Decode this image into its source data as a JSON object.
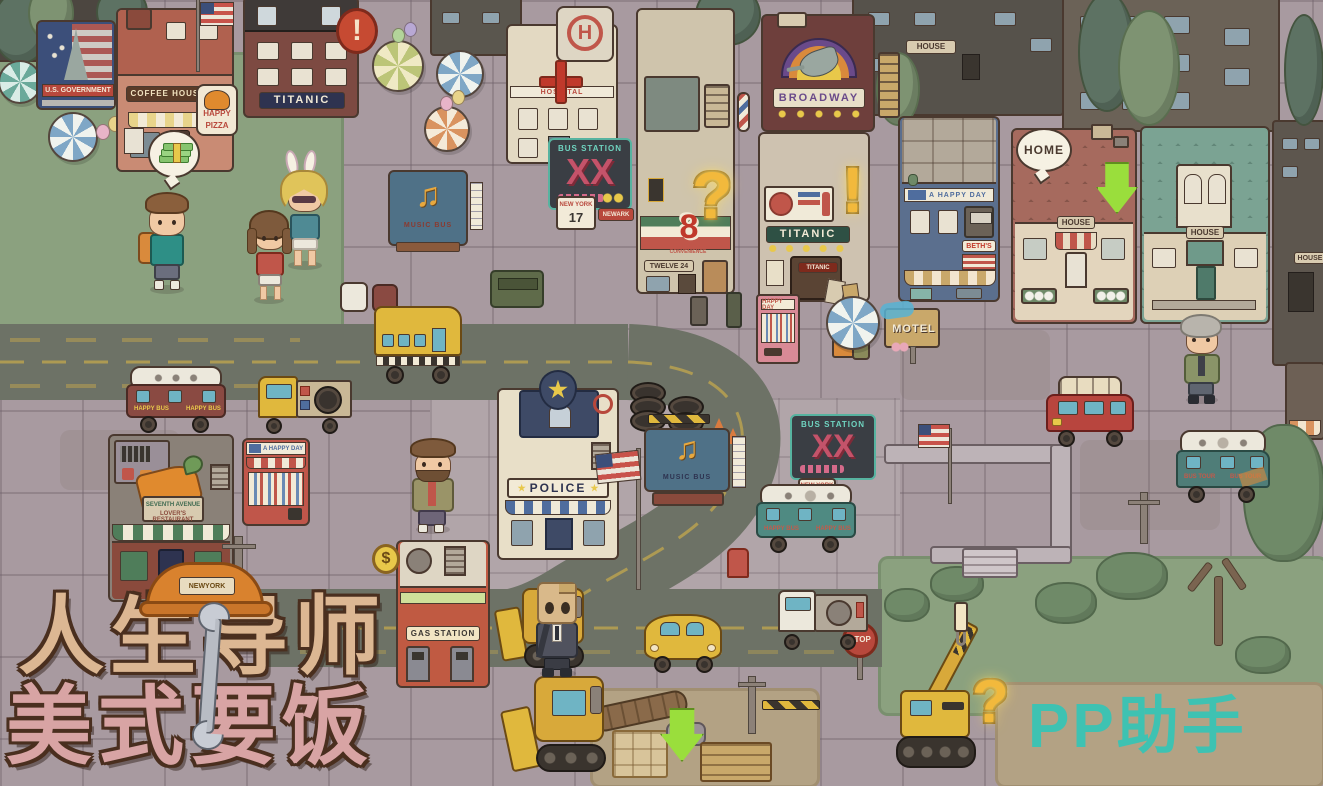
{
  "logo": {
    "line1": "人生导师",
    "line2": "美式要饭",
    "hat_badge": "NEWYORK"
  },
  "watermark": {
    "brand": "PP助手"
  },
  "colors": {
    "accent_gold": "#f2b93c",
    "marker_green": "#9ade3c",
    "watermark_teal": "#2fc7b9",
    "road": "#6d7266",
    "sidewalk": "#a89aa0",
    "grass": "#8ba17f"
  },
  "park": {
    "billboard": "U.S. GOVERNMENT"
  },
  "signs": {
    "top_mid_house": "HOUSE",
    "right_edge_house": "HOUSE"
  },
  "buildings": {
    "titanic_hotel": {
      "name": "TITANIC"
    },
    "coffee_house": {
      "name": "COFFEE HOUSE"
    },
    "happy_pizza": {
      "line1": "HAPPY",
      "line2": "PIZZA"
    },
    "hospital": {
      "helipad": "H",
      "name": "HOSPITAL"
    },
    "convenience": {
      "digit": "8",
      "label": "CONVENIENCE",
      "plaque": "TWELVE 24"
    },
    "broadway": {
      "name": "BROADWAY"
    },
    "titanic_bar": {
      "name": "TITANIC",
      "door": "TITANIC"
    },
    "beths": {
      "banner": "A HAPPY DAY",
      "shop": "BETH'S"
    },
    "house_red": {
      "name": "HOUSE"
    },
    "house_teal": {
      "name": "HOUSE"
    },
    "police": {
      "name": "POLICE"
    },
    "seventh_avenue": {
      "line1": "SEVENTH AVENUE",
      "line2": "LOVER'S RESTAURANT"
    },
    "happy_day_shop": {
      "banner": "A HAPPY DAY"
    },
    "gas_station": {
      "name": "GAS STATION"
    },
    "motel": {
      "name": "MOTEL"
    }
  },
  "street_signs": {
    "bus_station_a": {
      "title": "BUS STATION",
      "xx": "XX",
      "ny1": "NEW YORK",
      "ny2": "17",
      "aux": "NEWARK"
    },
    "bus_station_b": {
      "title": "BUS STATION",
      "xx": "XX",
      "ny1": "NEW YORK",
      "ny2": "17"
    },
    "stop": "STOP"
  },
  "stages": {
    "music_a": "MUSIC BUS",
    "music_b": "MUSIC BUS"
  },
  "vehicles": {
    "happy_bus_brown": "HAPPY BUS",
    "happy_bus_teal": "HAPPY BUS",
    "bus_tour": "BUS TOUR"
  },
  "vending": {
    "happy_day": "HAPPY DAY"
  },
  "markers": {
    "home": "HOME",
    "question": "?",
    "exclaim": "!",
    "money": "$"
  },
  "icons": {
    "star": "★",
    "note": "♫",
    "cross": "+"
  }
}
